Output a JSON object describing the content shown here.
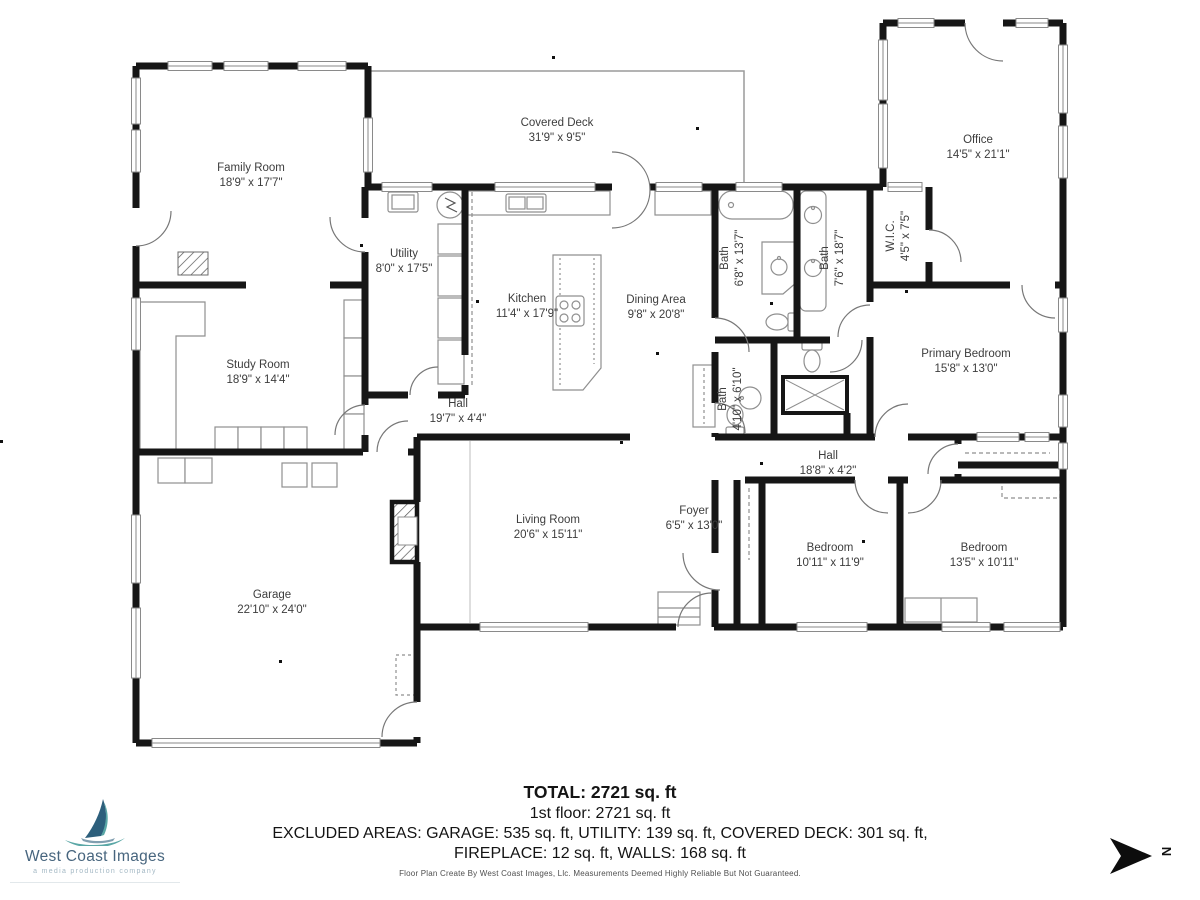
{
  "plan": {
    "rooms": [
      {
        "name": "Family Room",
        "dims": "18'9\" x 17'7\""
      },
      {
        "name": "Covered Deck",
        "dims": "31'9\" x 9'5\""
      },
      {
        "name": "Office",
        "dims": "14'5\" x 21'1\""
      },
      {
        "name": "Utility",
        "dims": "8'0\" x 17'5\""
      },
      {
        "name": "Kitchen",
        "dims": "11'4\" x 17'9\""
      },
      {
        "name": "Dining Area",
        "dims": "9'8\" x 20'8\""
      },
      {
        "name": "Bath",
        "dims": "6'8\" x 13'7\""
      },
      {
        "name": "Bath",
        "dims": "7'6\" x 18'7\""
      },
      {
        "name": "W.I.C.",
        "dims": "4'5\" x 7'5\""
      },
      {
        "name": "Primary Bedroom",
        "dims": "15'8\" x 13'0\""
      },
      {
        "name": "Bath",
        "dims": "4'10\" x 6'10\""
      },
      {
        "name": "Study Room",
        "dims": "18'9\" x 14'4\""
      },
      {
        "name": "Hall",
        "dims": "19'7\" x 4'4\""
      },
      {
        "name": "Hall",
        "dims": "18'8\" x 4'2\""
      },
      {
        "name": "Foyer",
        "dims": "6'5\" x 13'0\""
      },
      {
        "name": "Living Room",
        "dims": "20'6\" x 15'11\""
      },
      {
        "name": "Bedroom",
        "dims": "10'11\" x 11'9\""
      },
      {
        "name": "Bedroom",
        "dims": "13'5\" x 10'11\""
      },
      {
        "name": "Garage",
        "dims": "22'10\" x 24'0\""
      }
    ]
  },
  "summary": {
    "total": "TOTAL: 2721 sq. ft",
    "first_floor": "1st floor: 2721 sq. ft",
    "excluded_line1": "EXCLUDED AREAS: GARAGE: 535 sq. ft, UTILITY: 139 sq. ft, COVERED DECK: 301 sq. ft,",
    "excluded_line2": "FIREPLACE: 12 sq. ft, WALLS: 168 sq. ft"
  },
  "footer": {
    "disclaimer": "Floor Plan Create By West Coast Images, Llc. Measurements Deemed Highly Reliable But Not Guaranteed."
  },
  "logo": {
    "title": "West Coast Images",
    "subtitle": "a media production company"
  },
  "compass": {
    "label": "N"
  },
  "colors": {
    "wall": "#161616",
    "fixture": "#8f8f8f",
    "logo_sail": "#2d5f7c",
    "logo_teal": "#5aa7a6",
    "logo_text": "#47657e"
  }
}
